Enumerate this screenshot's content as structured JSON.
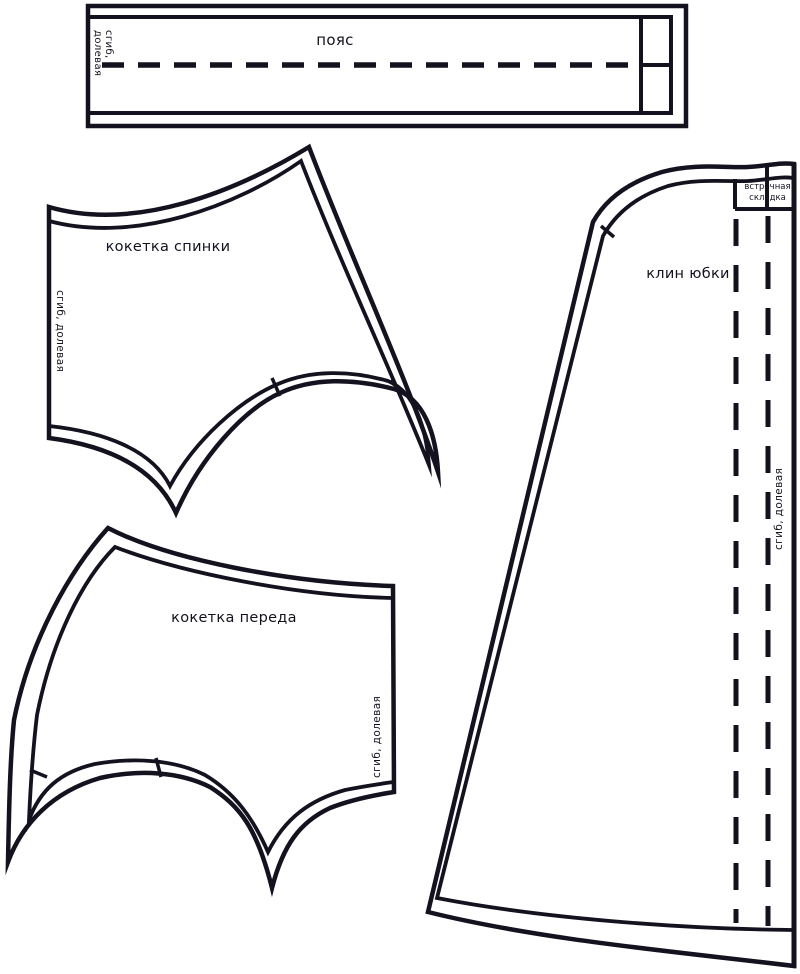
{
  "sheet": {
    "background": "#ffffff",
    "line_color": "#14121f"
  },
  "pieces": {
    "waistband": {
      "label": "пояс",
      "grain_label": "сгиб, долевая",
      "fold_line_style": "dashed"
    },
    "back_yoke": {
      "label": "кокетка спинки",
      "grain_label": "сгиб, долевая",
      "notches": 2
    },
    "front_yoke": {
      "label": "кокетка переда",
      "grain_label": "сгиб, долевая",
      "notches": 2
    },
    "skirt_gore": {
      "label": "клин юбки",
      "grain_label": "сгиб, долевая",
      "pleat_label": "встречная складка",
      "pleat_line_style": "dashed",
      "notches": 1
    }
  }
}
